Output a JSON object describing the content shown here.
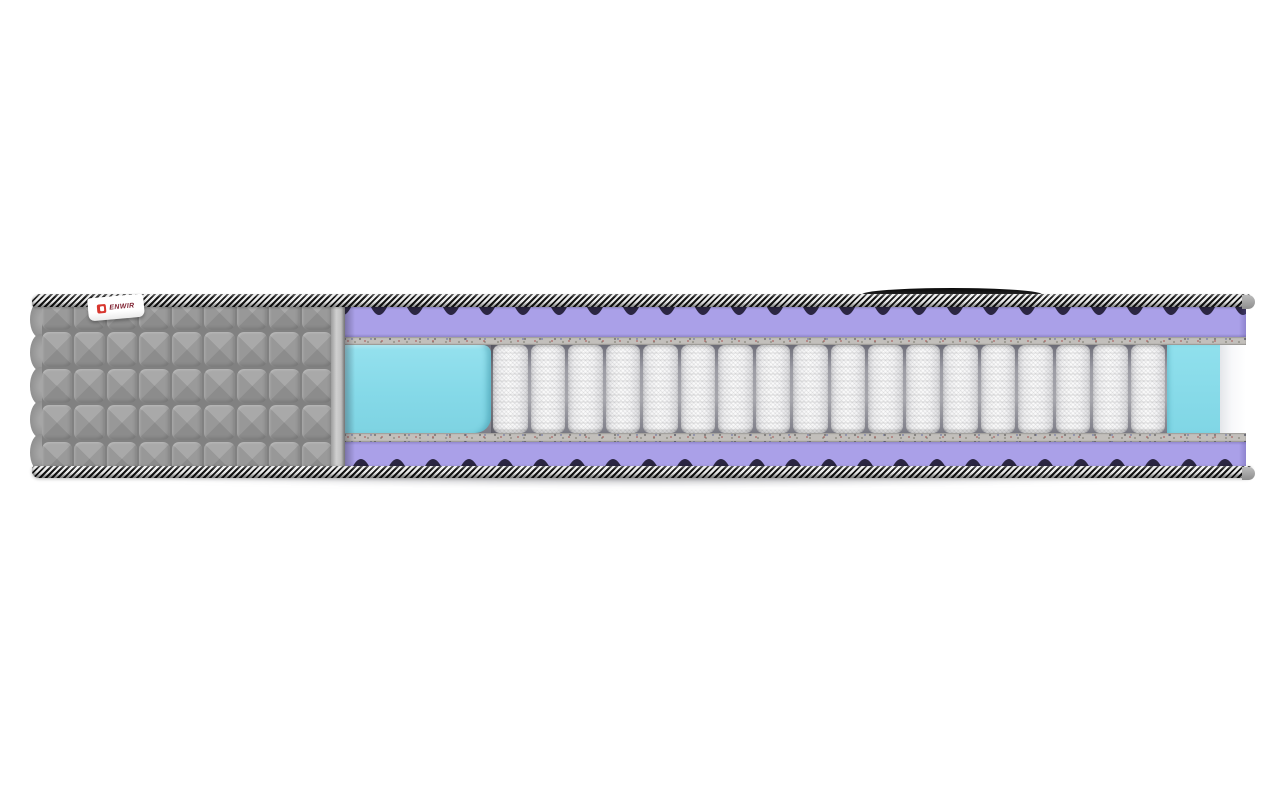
{
  "image": {
    "description": "Cutaway cross-section render of an orthopedic pocket-spring mattress on a white background",
    "background_color": "#ffffff"
  },
  "brand_tag": {
    "text": "ENWIR",
    "bg_color": "#ffffff",
    "text_color": "#7e2130",
    "icon_color": "#d8372f"
  },
  "handle": {
    "color": "#141414"
  },
  "cover": {
    "name": "gray quilted fabric cover",
    "color": "#9b9b9b",
    "seam_color": "#818181",
    "cut_edge_color": "#c6c6c6",
    "quilt_cell_count": 45,
    "quilt_columns": 9,
    "quilt_rows": 5,
    "scallop_count": 5
  },
  "border_tape": {
    "stripe_dark": "#151515",
    "stripe_light": "#ececec"
  },
  "layers": {
    "foam_top": {
      "name": "egg-crate foam layer (top)",
      "color": "#aaa0e8",
      "shadow_color": "#2b2642"
    },
    "felt_top": {
      "name": "felt pad (top)",
      "color": "#c2bfbb"
    },
    "springs": {
      "name": "independent pocket springs",
      "count": 18,
      "color": "#f6f6f6",
      "gap_color": "#8b8b95"
    },
    "foam_block_left": {
      "name": "foam block (left end)",
      "color": "#87d9e8"
    },
    "foam_block_right": {
      "name": "foam block (right end)",
      "color": "#87d9e8"
    },
    "felt_bottom": {
      "name": "felt pad (bottom)",
      "color": "#c2bfbb"
    },
    "foam_bottom": {
      "name": "egg-crate foam layer (bottom)",
      "color": "#aaa0e8",
      "shadow_color": "#2b2642"
    }
  }
}
